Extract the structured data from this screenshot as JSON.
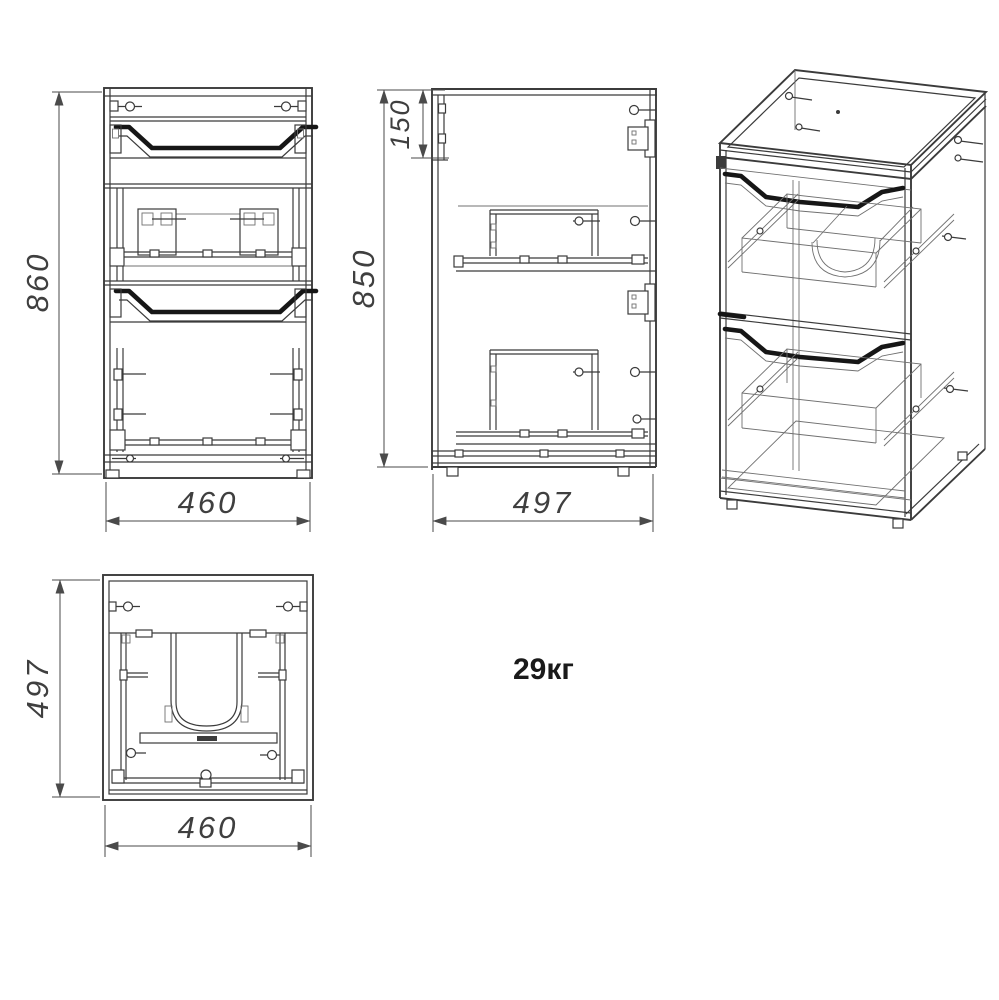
{
  "drawing": {
    "weight": "29кг",
    "views": {
      "front": {
        "height": "860",
        "width": "460"
      },
      "side": {
        "drawer_front": "150",
        "height": "850",
        "depth": "497"
      },
      "top": {
        "depth": "497",
        "width": "460"
      }
    },
    "colors": {
      "line": "#3b3b3b",
      "line_light": "#707070",
      "handle": "#161616",
      "dim_line": "#4a4a4a",
      "dim_text": "#3f3f3f",
      "weight_text": "#1a1a1a",
      "background": "#ffffff"
    }
  }
}
